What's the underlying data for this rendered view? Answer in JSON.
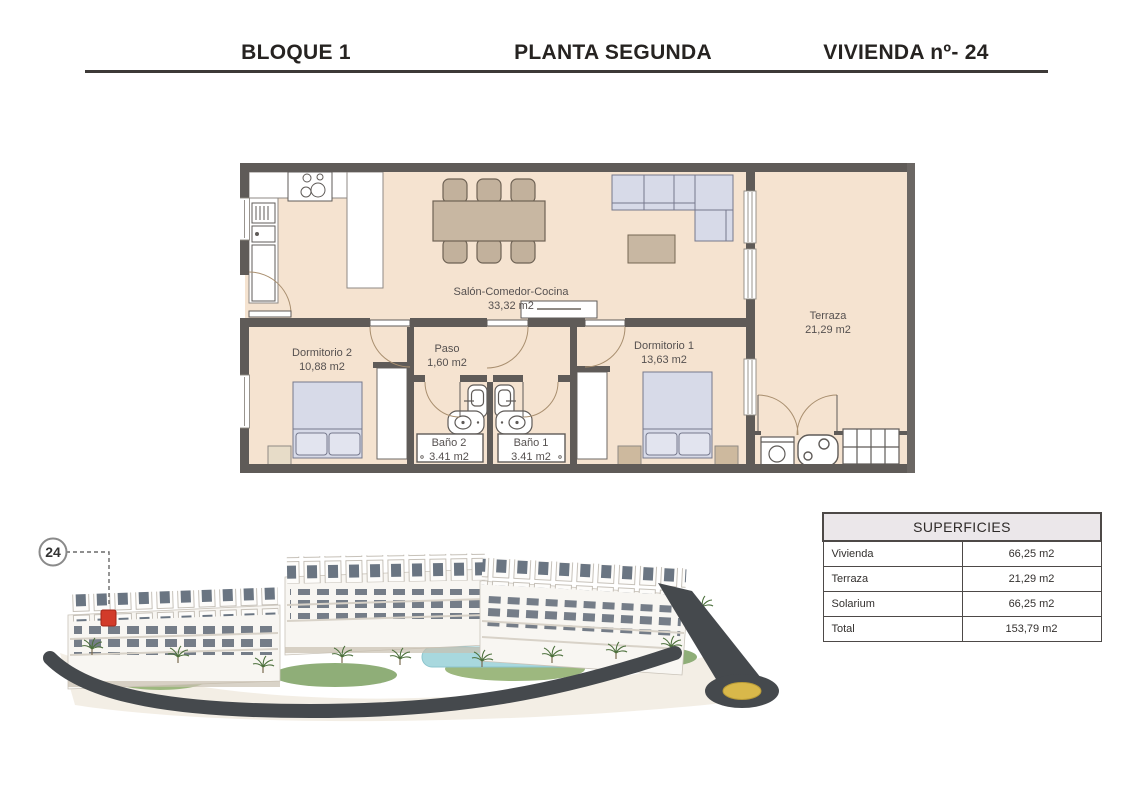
{
  "header": {
    "block": "BLOQUE 1",
    "floor": "PLANTA SEGUNDA",
    "unit": "VIVIENDA nº- 24"
  },
  "floor_plan": {
    "rooms": [
      {
        "name": "Salón-Comedor-Cocina",
        "area": "33,32 m2"
      },
      {
        "name": "Paso",
        "area": "1,60 m2"
      },
      {
        "name": "Dormitorio 2",
        "area": "10,88 m2"
      },
      {
        "name": "Dormitorio 1",
        "area": "13,63 m2"
      },
      {
        "name": "Baño 2",
        "area": "3.41 m2"
      },
      {
        "name": "Baño 1",
        "area": "3.41 m2"
      },
      {
        "name": "Terraza",
        "area": "21,29 m2"
      }
    ]
  },
  "site": {
    "unit_marker": "24"
  },
  "surfaces_table": {
    "title": "SUPERFICIES",
    "rows": [
      {
        "label": "Vivienda",
        "value": "66,25 m2"
      },
      {
        "label": "Terraza",
        "value": "21,29 m2"
      },
      {
        "label": "Solarium",
        "value": "66,25 m2"
      },
      {
        "label": "Total",
        "value": "153,79 m2"
      }
    ]
  },
  "colors": {
    "wall": "#5f5b58",
    "floor": "#f5e3d0",
    "accent_red": "#d23b2a",
    "roundabout_gold": "#d9b84a",
    "pool": "#a8d8de"
  }
}
